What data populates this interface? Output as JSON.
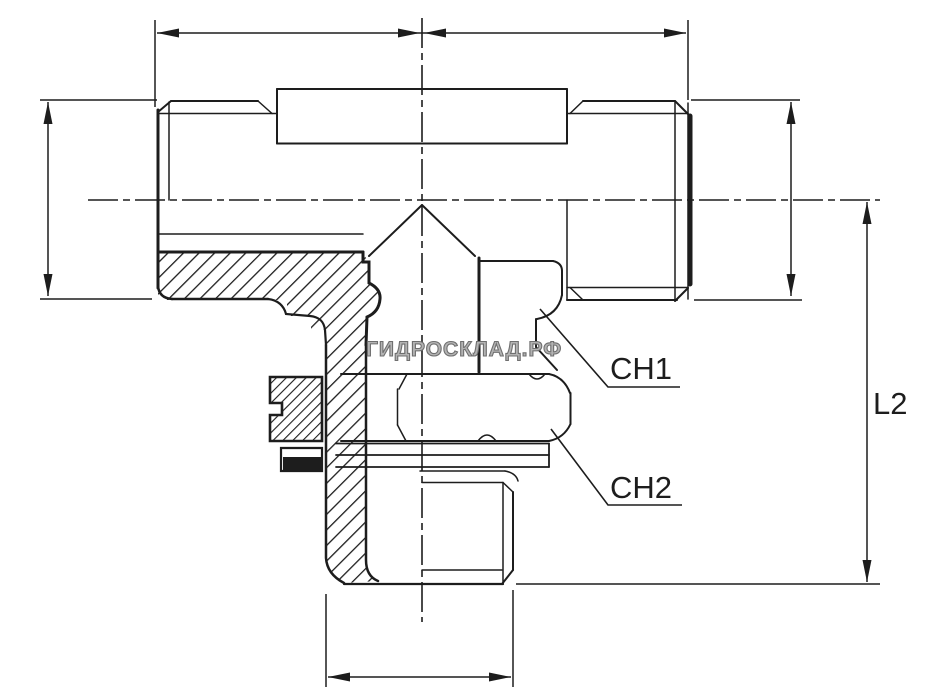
{
  "drawing": {
    "labels": {
      "ch1": "CH1",
      "ch2": "CH2",
      "l2": "L2"
    },
    "watermark": "ГИДРОСКЛАД.РФ",
    "colors": {
      "background": "#ffffff",
      "ink": "#1d1d1d",
      "watermark_fill": "#b3b3b3",
      "watermark_outline": "#6f6f6f"
    }
  }
}
